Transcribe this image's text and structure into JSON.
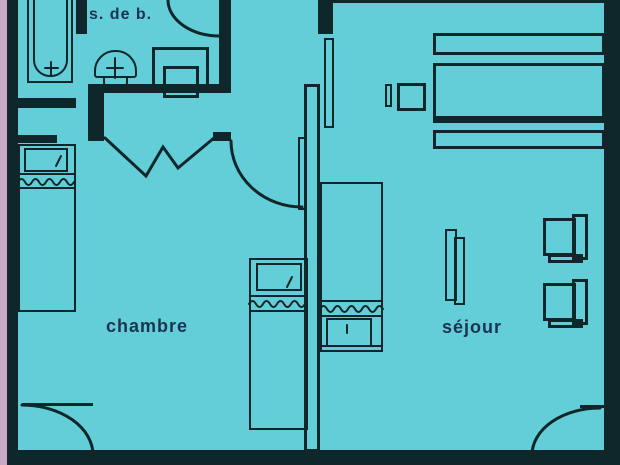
{
  "floor_plan": {
    "type": "apartment-floor-plan",
    "background_color": "#63ced8",
    "line_color": "#0f272b",
    "text_color": "#1b3350",
    "edge_strip_color": "#c9a7c7",
    "rooms": [
      {
        "name": "salle-de-bain",
        "label": "s. de b."
      },
      {
        "name": "chambre",
        "label": "chambre"
      },
      {
        "name": "sejour",
        "label": "séjour"
      }
    ],
    "fixtures": [
      "bathtub",
      "washbasin",
      "toilet",
      "entry-door-swing",
      "folding-accordion-door",
      "bedroom-door-swing",
      "bed-left",
      "bed-middle",
      "bed-right",
      "kitchen-counter-top",
      "kitchen-counter-main",
      "kitchen-counter-low",
      "stove-unit",
      "wall-duct",
      "radiator-shelf",
      "armchair-1",
      "armchair-2",
      "door-swing-bottom-left",
      "door-swing-bottom-right"
    ]
  }
}
